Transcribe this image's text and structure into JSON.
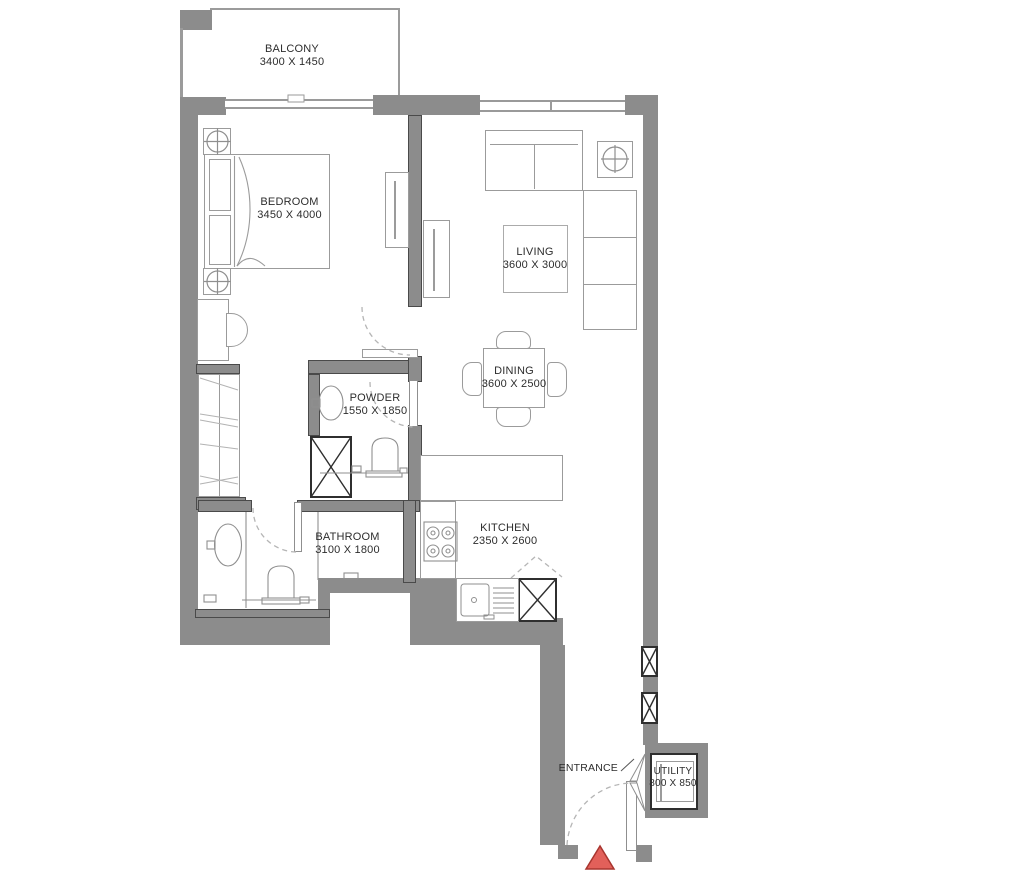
{
  "plan_type": "apartment-floor-plan",
  "rooms": [
    {
      "id": "balcony",
      "name": "BALCONY",
      "dims": "3400 X 1450"
    },
    {
      "id": "bedroom",
      "name": "BEDROOM",
      "dims": "3450 X 4000"
    },
    {
      "id": "living",
      "name": "LIVING",
      "dims": "3600 X 3000"
    },
    {
      "id": "dining",
      "name": "DINING",
      "dims": "3600 X 2500"
    },
    {
      "id": "powder",
      "name": "POWDER",
      "dims": "1550 X 1850"
    },
    {
      "id": "kitchen",
      "name": "KITCHEN",
      "dims": "2350 X 2600"
    },
    {
      "id": "bathroom",
      "name": "BATHROOM",
      "dims": "3100 X 1800"
    },
    {
      "id": "utility",
      "name": "UTILITY",
      "dims": "800 X 850"
    }
  ],
  "labels": {
    "entrance": "ENTRANCE"
  },
  "colors": {
    "wall": "#8c8c8c",
    "line": "#9b9b9b",
    "text": "#2d2d2d",
    "entrance_marker": "#e2605a",
    "entrance_marker_border": "#a8352f"
  },
  "icons": {
    "entrance_marker": "red-triangle",
    "shaft": "x-cross-box",
    "lamp": "circle-cross",
    "door_swing": "dashed-quarter-arc"
  }
}
